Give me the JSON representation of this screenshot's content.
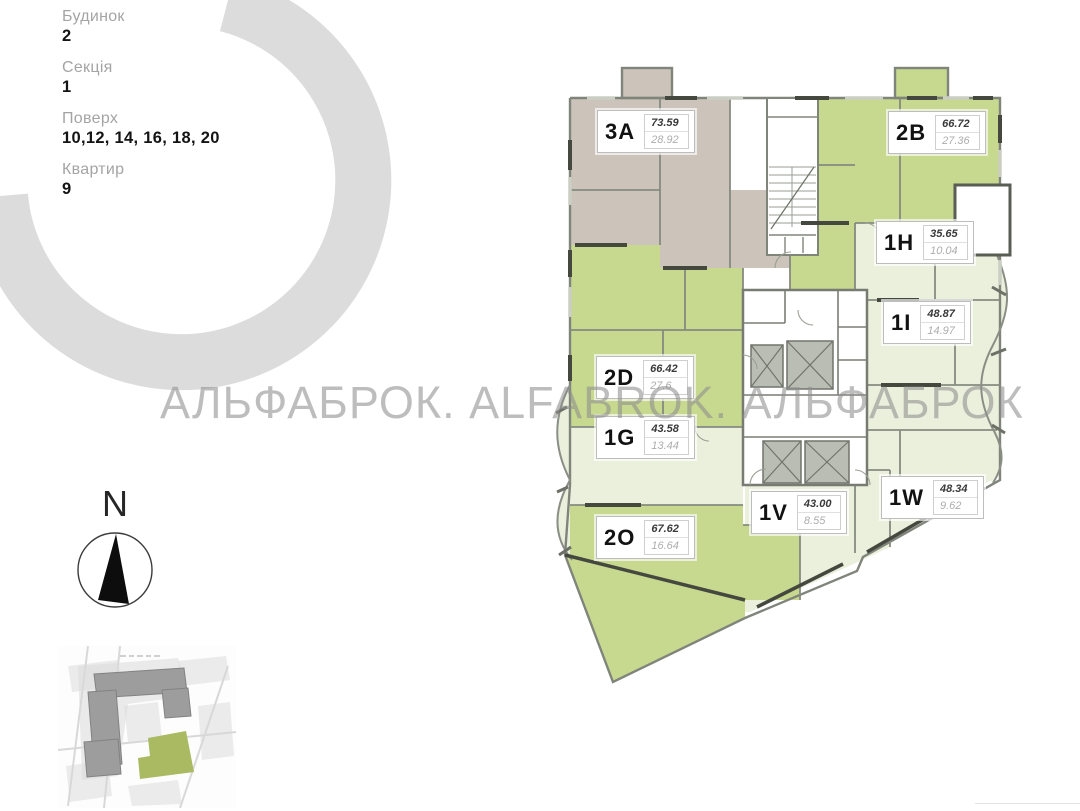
{
  "legend": {
    "items": [
      {
        "label": "Будинок",
        "value": "2"
      },
      {
        "label": "Секція",
        "value": "1"
      },
      {
        "label": "Поверх",
        "value": "10,12, 14, 16, 18, 20"
      },
      {
        "label": "Квартир",
        "value": "9"
      }
    ]
  },
  "watermark": {
    "text": "АЛЬФАБРОК. ALFABROK. АЛЬФАБРОК"
  },
  "compass": {
    "label": "N"
  },
  "floorplan": {
    "apartments": [
      {
        "code": "3A",
        "area_total": "73.59",
        "area_second": "28.92",
        "color_key": "taupe"
      },
      {
        "code": "2B",
        "area_total": "66.72",
        "area_second": "27.36",
        "color_key": "green"
      },
      {
        "code": "1H",
        "area_total": "35.65",
        "area_second": "10.04",
        "color_key": "pale"
      },
      {
        "code": "1I",
        "area_total": "48.87",
        "area_second": "14.97",
        "color_key": "pale"
      },
      {
        "code": "2D",
        "area_total": "66.42",
        "area_second": "27.6",
        "color_key": "green"
      },
      {
        "code": "1G",
        "area_total": "43.58",
        "area_second": "13.44",
        "color_key": "pale"
      },
      {
        "code": "2O",
        "area_total": "67.62",
        "area_second": "16.64",
        "color_key": "green"
      },
      {
        "code": "1V",
        "area_total": "43.00",
        "area_second": "8.55",
        "color_key": "pale"
      },
      {
        "code": "1W",
        "area_total": "48.34",
        "area_second": "9.62",
        "color_key": "pale"
      }
    ]
  },
  "colors": {
    "apartment_green": "#c7d88f",
    "apartment_pale": "#eaf0dc",
    "apartment_taupe": "#ccc4ba",
    "wall_gray": "#80857b",
    "wall_dark": "#45483f",
    "ring_gray": "#dcdcdc",
    "watermark_gray": "#8f8f8f",
    "map_building_gray": "#9d9d9d",
    "map_highlight_green": "#a9ba62"
  }
}
